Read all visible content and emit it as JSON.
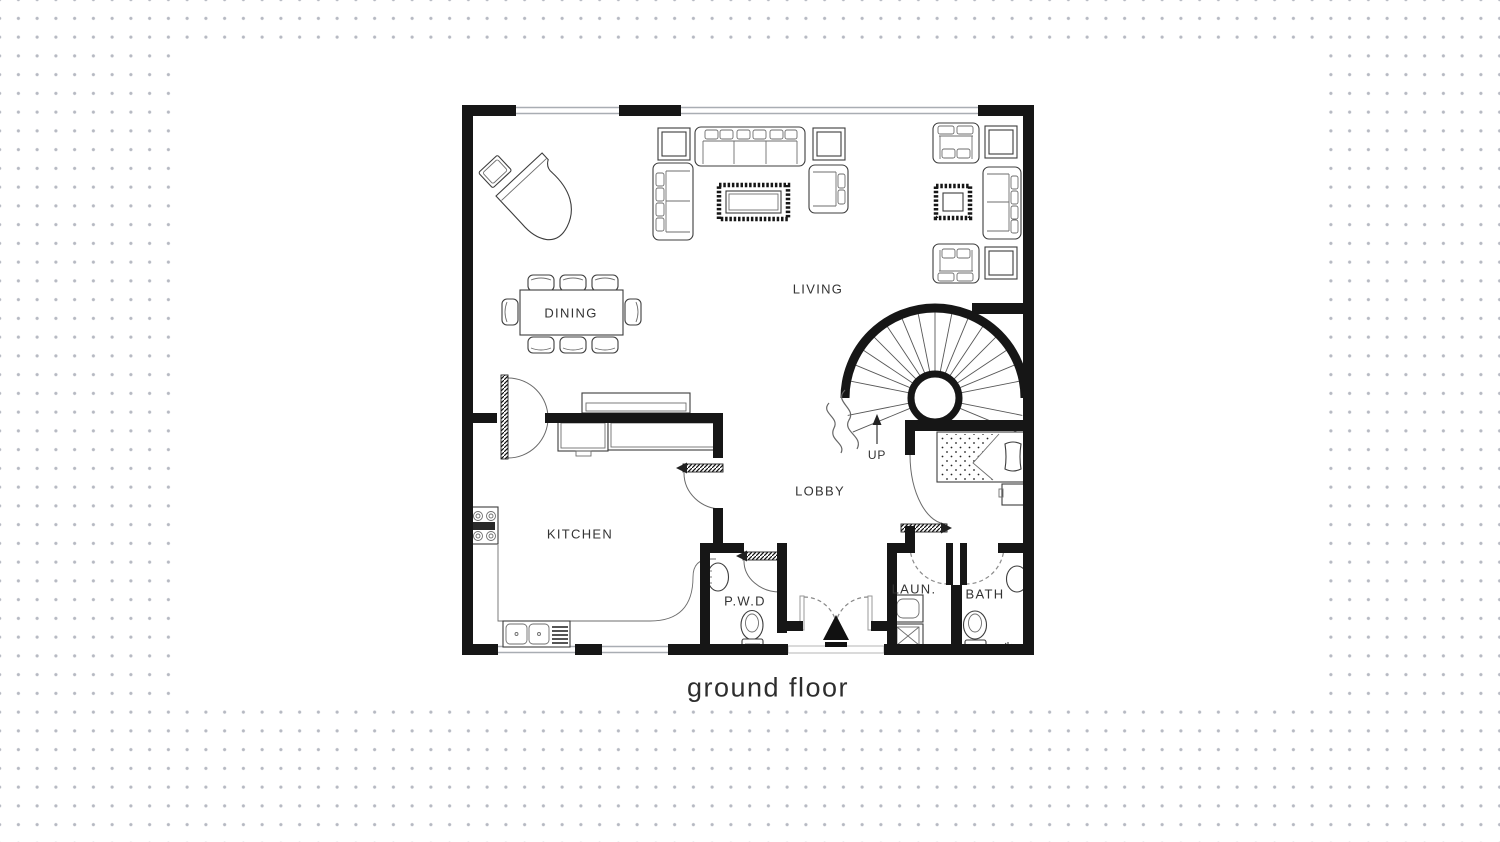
{
  "plan": {
    "caption": "ground floor",
    "rooms": {
      "living": "LIVING",
      "dining": "DINING",
      "kitchen": "KITCHEN",
      "lobby": "LOBBY",
      "pwd": "P.W.D",
      "laundry": "LAUN.",
      "bath": "BATH"
    },
    "stair": {
      "direction_label": "UP"
    },
    "colors": {
      "wall": "#161616",
      "line": "#3d3d3d",
      "label": "#333333",
      "dot": "#b6b9c2",
      "paper": "#ffffff",
      "background": "#ffffff"
    }
  }
}
